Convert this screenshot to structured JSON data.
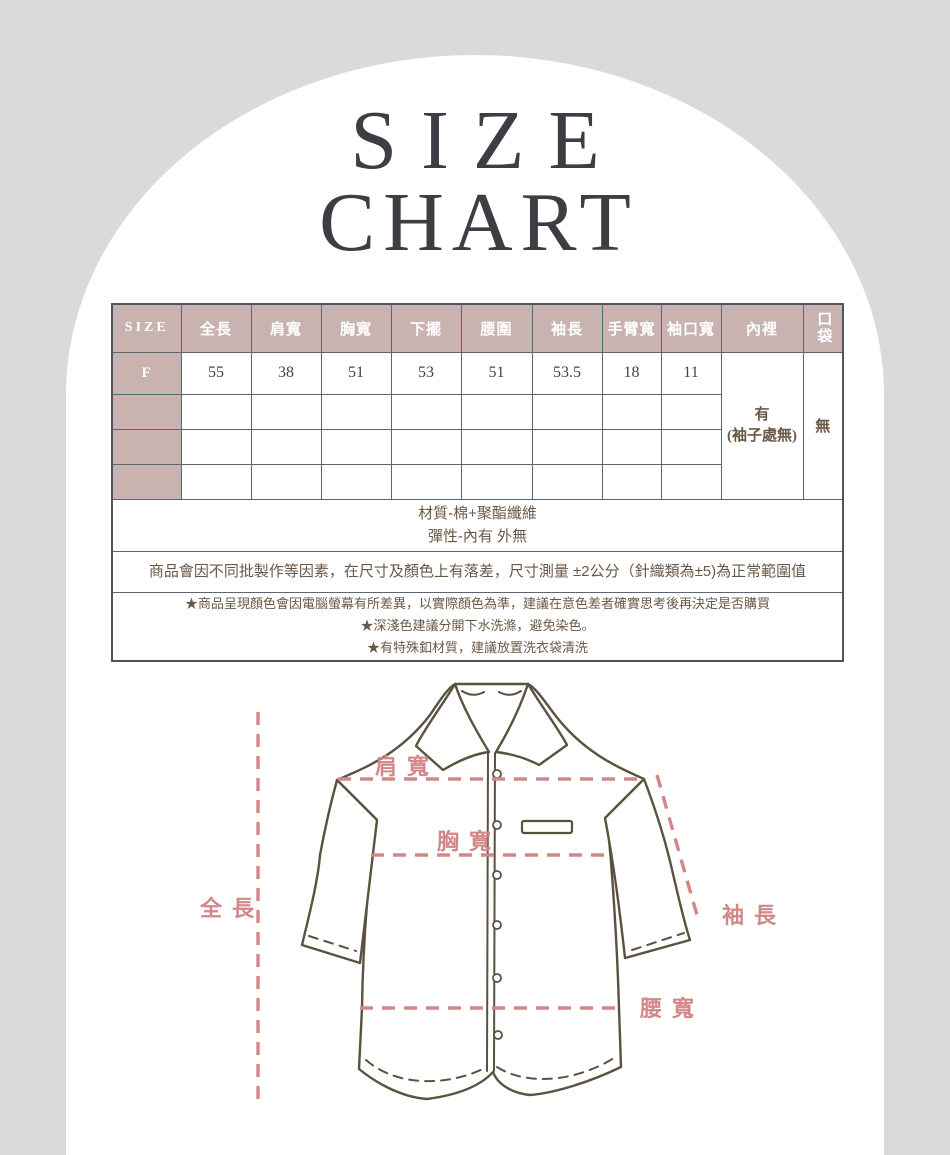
{
  "title": {
    "line1": "SIZE",
    "line2": "CHART"
  },
  "size_table": {
    "headers": [
      "SIZE",
      "全長",
      "肩寬",
      "胸寬",
      "下擺",
      "腰圍",
      "袖長",
      "手臂寬",
      "袖口寬",
      "內裡",
      "口袋"
    ],
    "row_f": {
      "size_label": "F",
      "values": [
        "55",
        "38",
        "51",
        "53",
        "51",
        "53.5",
        "18",
        "11"
      ],
      "lining": "有\n(袖子處無)",
      "pocket": "無"
    },
    "empty_rows": 3
  },
  "notes": {
    "material_line1": "材質-棉+聚酯纖維",
    "material_line2": "彈性-內有 外無",
    "tolerance": "商品會因不同批製作等因素，在尺寸及顏色上有落差，尺寸測量 ±2公分（針織類為±5)為正常範圍值",
    "warnings": [
      "★商品呈現顏色會因電腦螢幕有所差異，以實際顏色為準，建議在意色差者確實思考後再決定是否購買",
      "★深淺色建議分開下水洗滌，避免染色。",
      "★有特殊釦材質，建議放置洗衣袋清洗"
    ]
  },
  "diagram": {
    "labels": {
      "shoulder": "肩寬",
      "chest": "胸寬",
      "length": "全長",
      "sleeve": "袖長",
      "waist": "腰寬"
    }
  },
  "colors": {
    "background_gray": "#d9dadb",
    "panel_white": "#ffffff",
    "header_mauve": "#c8b3b0",
    "table_border": "#4d5560",
    "note_brown": "#6a5847",
    "accent_pink": "#d28789",
    "shirt_outline": "#5a523f",
    "title_dark": "#3b3e43"
  }
}
